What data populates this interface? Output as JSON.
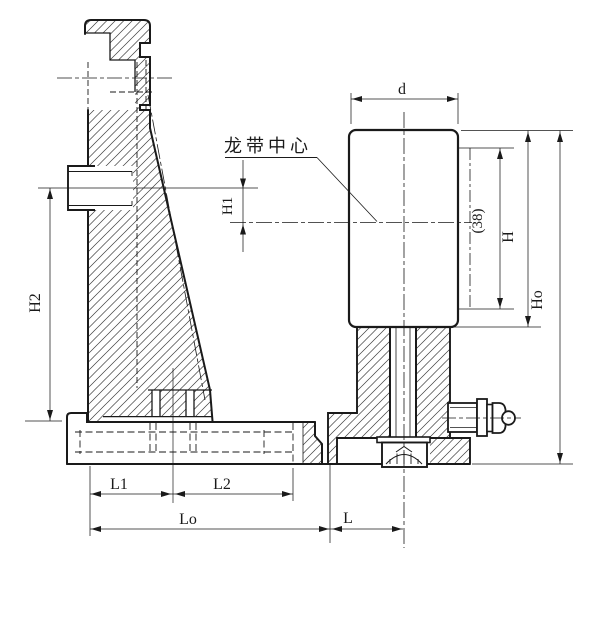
{
  "drawing": {
    "note_belt_center": "龙带中心",
    "labels": {
      "d": "d",
      "h1": "H1",
      "h2": "H2",
      "h": "H",
      "ho": "Ho",
      "ref38": "(38)",
      "l1": "L1",
      "l2": "L2",
      "lo": "Lo",
      "l": "L"
    },
    "colors": {
      "line": "#1a1a1a",
      "background": "#ffffff"
    }
  }
}
